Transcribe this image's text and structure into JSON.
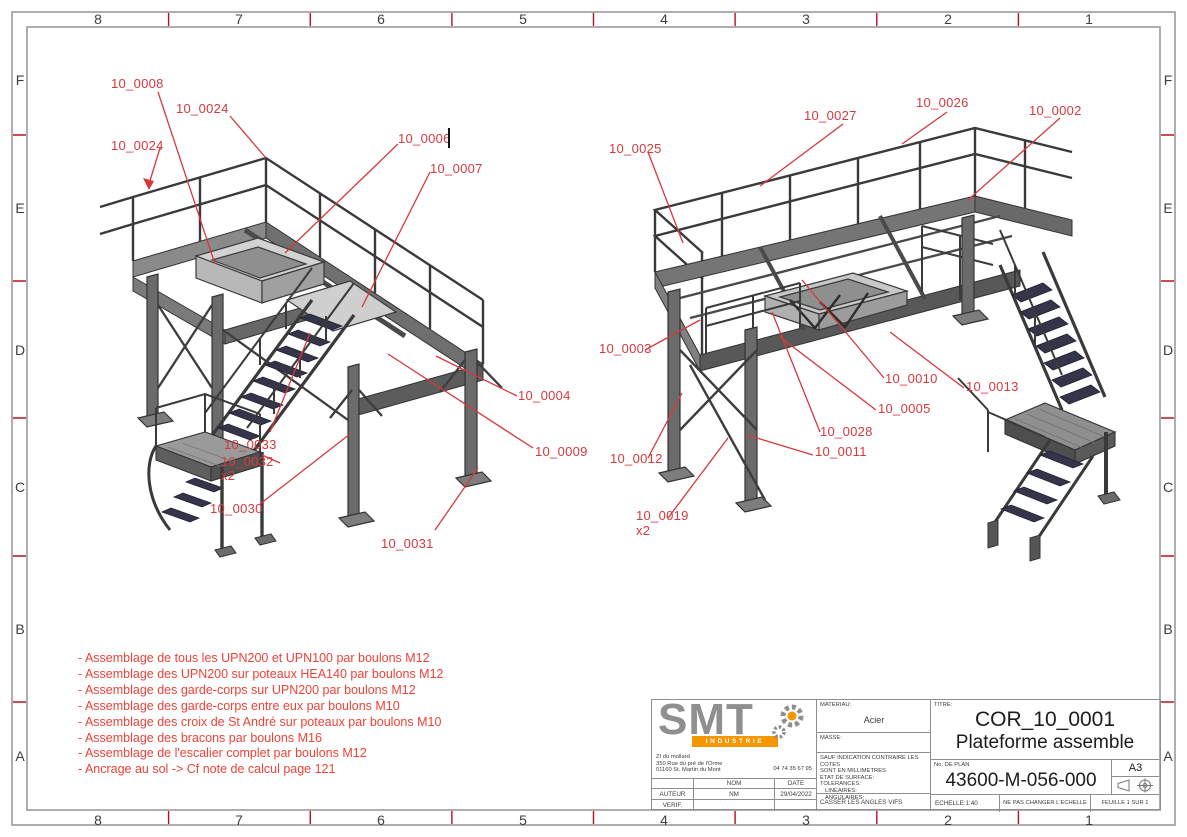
{
  "zones": {
    "cols": [
      "8",
      "7",
      "6",
      "5",
      "4",
      "3",
      "2",
      "1"
    ],
    "rows": [
      "F",
      "E",
      "D",
      "C",
      "B",
      "A"
    ]
  },
  "callouts": {
    "left": [
      "10_0008",
      "10_0024",
      "10_0024",
      "10_0006",
      "10_0007",
      "10_0004",
      "10_0009",
      "10_0033",
      "10_0032",
      "x2",
      "10_0030",
      "10_0031"
    ],
    "right": [
      "10_0025",
      "10_0027",
      "10_0026",
      "10_0002",
      "10_0003",
      "10_0010",
      "10_0013",
      "10_0005",
      "10_0028",
      "10_0011",
      "10_0012",
      "10_0019",
      "x2"
    ]
  },
  "notes": [
    "- Assemblage de tous les UPN200 et UPN100 par boulons M12",
    "- Assemblage des UPN200 sur poteaux HEA140 par boulons M12",
    "- Assemblage des garde-corps sur UPN200 par boulons M12",
    "- Assemblage des garde-corps entre eux par boulons M10",
    "- Assemblage des croix de St André sur poteaux par boulons M10",
    "- Assemblage des bracons par boulons M16",
    "- Assemblage de l'escalier complet par boulons M12",
    "- Ancrage au sol -> Cf note de calcul page 121"
  ],
  "title_block": {
    "brand": "SMT",
    "brand_sub": "INDUSTRIE",
    "address_line1": "ZI du mollard",
    "address_line2": "350 Rue du pré de l'Orme",
    "address_line3": "01160 St. Martin du Mont",
    "phone": "04 74 35 67 95",
    "col_nom": "NOM",
    "col_date": "DATE",
    "row_auteur": "AUTEUR",
    "auteur_nom": "NM",
    "auteur_date": "29/04/2022",
    "row_verif": "VERIF.",
    "materiau_label": "MATERIAU:",
    "materiau_value": "Acier",
    "masse_label": "MASSE:",
    "spec1": "SAUF INDICATION CONTRAIRE LES COTES",
    "spec2": "SONT EN MILLIMETRES",
    "spec3": "ETAT DE SURFACE:",
    "spec4": "TOLERANCES:",
    "spec5": "LINEAIRES:",
    "spec6": "ANGULAIRES:",
    "casser": "CASSER LES ANGLES VIFS",
    "titre_label": "TITRE:",
    "titre1": "COR_10_0001",
    "titre2": "Plateforme assemble",
    "plan_label": "No. DE PLAN",
    "plan_value": "43600-M-056-000",
    "format": "A3",
    "echelle": "ECHELLE:1:40",
    "echelle_note": "NE PAS CHANGER L'ECHELLE",
    "feuille": "FEUILLE 1 SUR 1"
  },
  "colors": {
    "callout_red": "#d6393c",
    "note_red": "#ee4238",
    "border_gray": "#9a9a9a",
    "tick_red": "#b51220",
    "structure_dark": "#3a3a3a",
    "tread_navy": "#34344a",
    "logo_gray": "#8f8f8f",
    "logo_orange": "#f49600"
  }
}
